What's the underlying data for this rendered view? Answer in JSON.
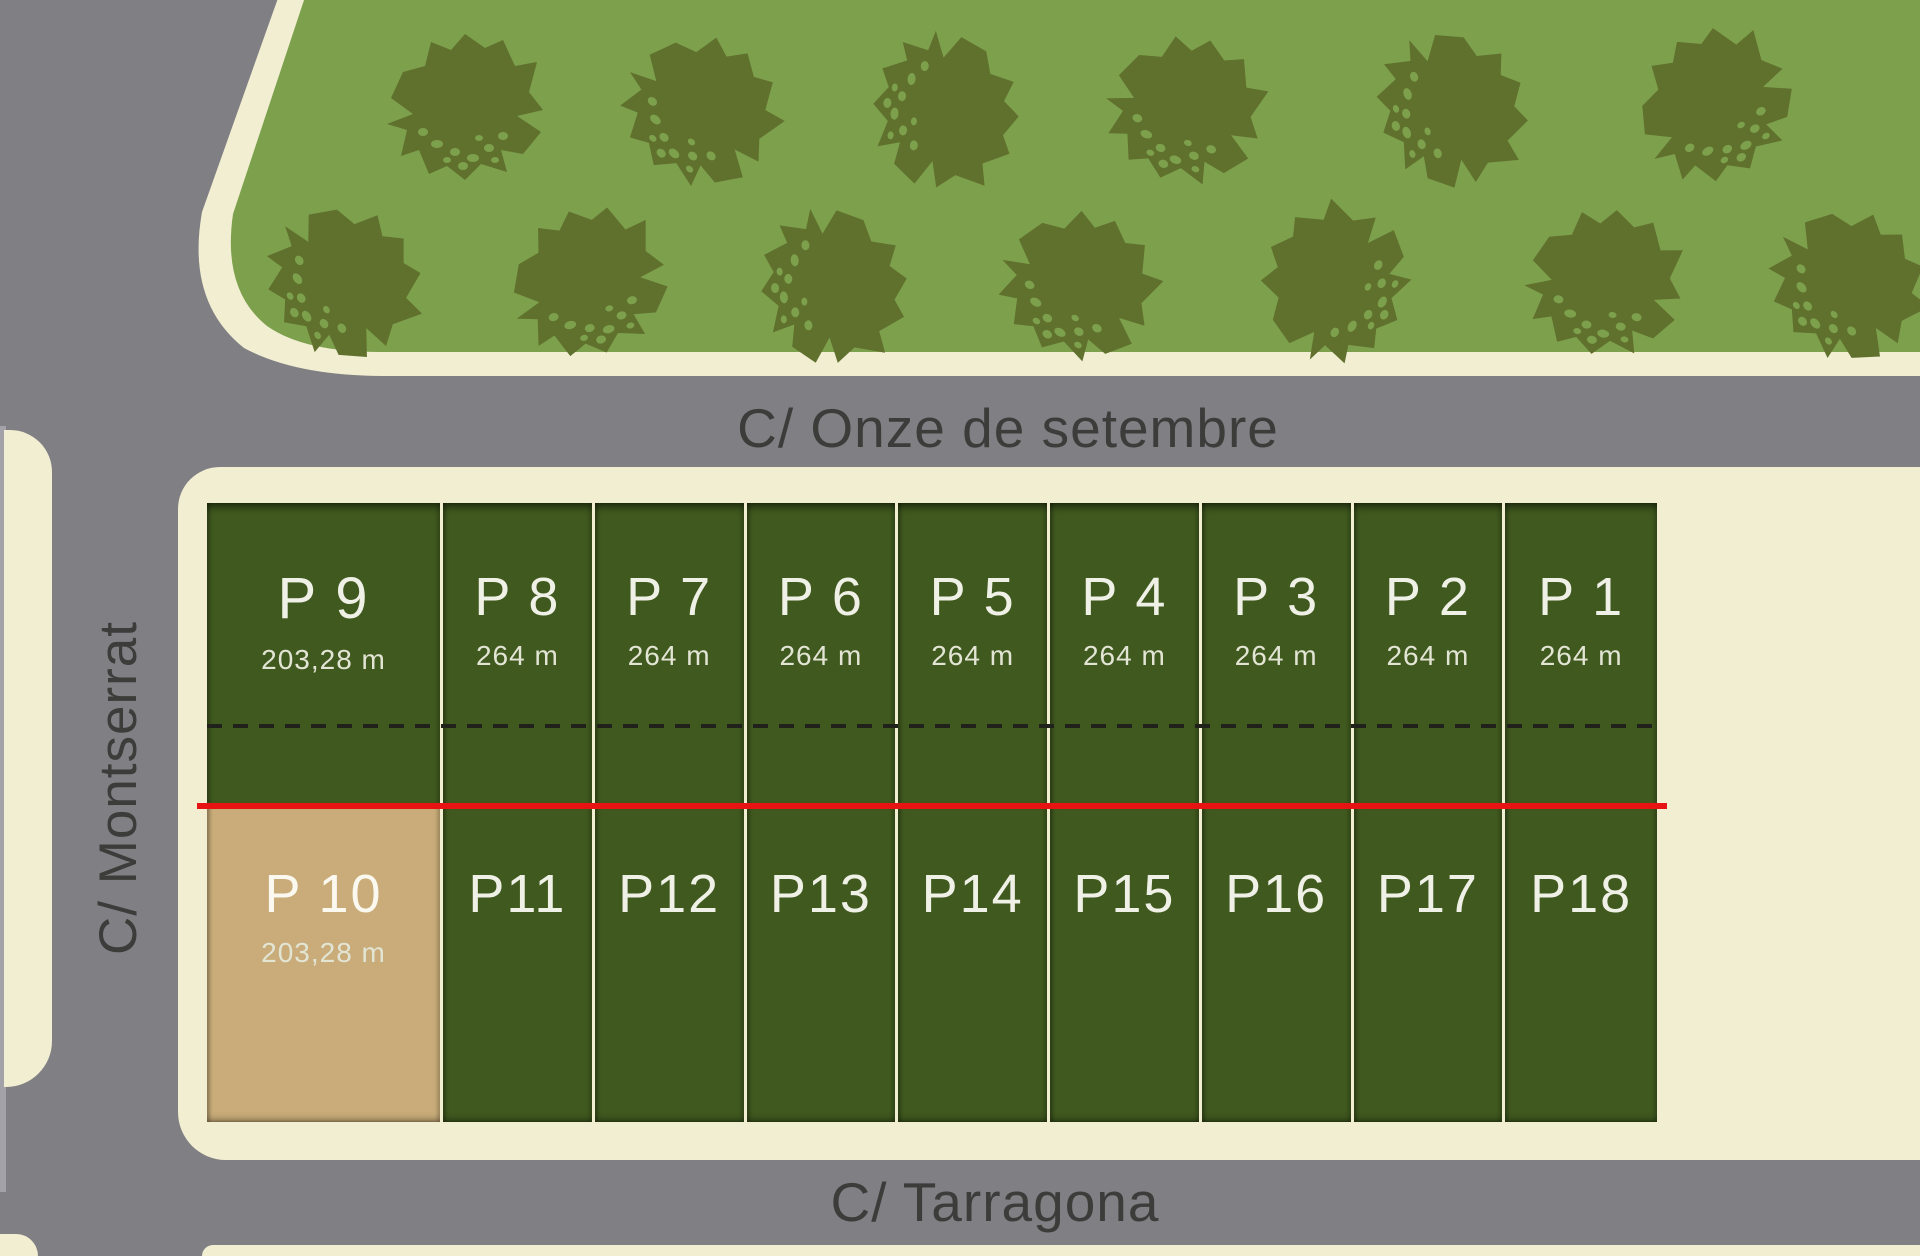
{
  "map": {
    "title": "Parcel site plan",
    "streets": {
      "top": "C/ Onze de setembre",
      "left": "C/ Montserrat",
      "bottom": "C/ Tarragona"
    },
    "plots": {
      "top_row": [
        {
          "id": "P 9",
          "area": "203,28 m"
        },
        {
          "id": "P 8",
          "area": "264 m"
        },
        {
          "id": "P 7",
          "area": "264 m"
        },
        {
          "id": "P 6",
          "area": "264 m"
        },
        {
          "id": "P 5",
          "area": "264 m"
        },
        {
          "id": "P 4",
          "area": "264 m"
        },
        {
          "id": "P 3",
          "area": "264 m"
        },
        {
          "id": "P 2",
          "area": "264 m"
        },
        {
          "id": "P 1",
          "area": "264 m"
        }
      ],
      "bottom_row": [
        {
          "id": "P 10",
          "area": "203,28 m",
          "status": "highlighted"
        },
        {
          "id": "P11"
        },
        {
          "id": "P12"
        },
        {
          "id": "P13"
        },
        {
          "id": "P14"
        },
        {
          "id": "P15"
        },
        {
          "id": "P16"
        },
        {
          "id": "P17"
        },
        {
          "id": "P18"
        }
      ]
    },
    "park": {
      "trees_upper_row": 6,
      "trees_lower_row": 7
    },
    "colors": {
      "street_gray": "#807f83",
      "street_text": "#3c3c3a",
      "curb_cream": "#f1eed2",
      "park_green": "#7da04d",
      "tree_olive": "#60702d",
      "plot_green": "#40591f",
      "plot_tan": "#c9ac79",
      "boundary_red": "#e81313",
      "label_white": "#f0f1e6",
      "area_text": "#e3e5d4"
    }
  }
}
